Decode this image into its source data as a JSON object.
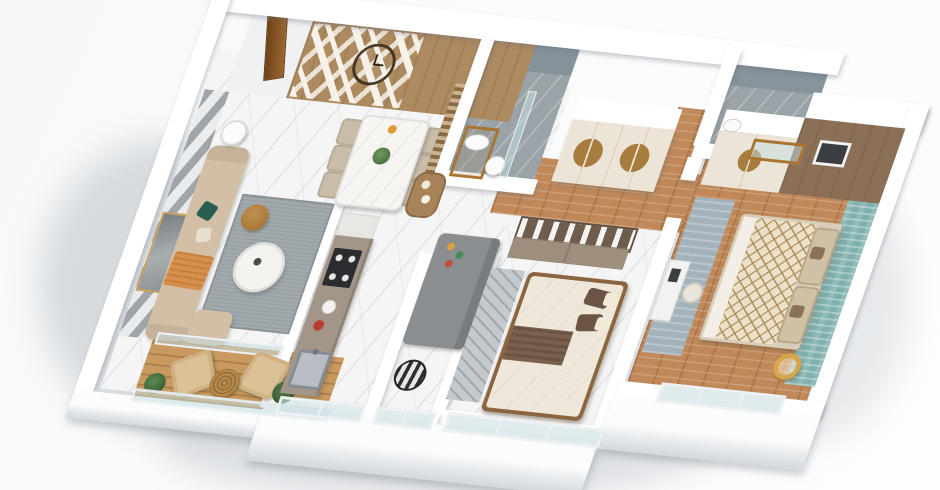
{
  "scene": {
    "type": "3d-apartment-floor-plan-render",
    "view": "isometric top-down",
    "visible_text": "none",
    "background": "#fafbfc"
  },
  "palette": {
    "outer_wall": "#ffffff",
    "wall_shadow": "#d4d9dd",
    "marble_floor": "#f5f5f6",
    "wood_floor": "#c1895a",
    "balcony_deck": "#c99a5f",
    "feature_wood_wall": "#ad8a5f",
    "accent_stripe_gray": "#9fa5a8",
    "sofa_beige": "#d3bfa6",
    "pillow_green": "#275e4d",
    "throw_orange": "#d78f4d",
    "rug_gray": "#99a1a6",
    "counter_taupe": "#a39689",
    "stove_black": "#2b2c30",
    "bathroom_gray": "#9aa3a7",
    "wardrobe_cream": "#ece4d6",
    "wood_handle": "#a87c3e",
    "closet_taupe": "#9d8e7d",
    "bed_brown_pillow": "#6b5444",
    "bed_runner_brown": "#7b604d",
    "duvet_lattice": "#ece1c8",
    "lattice_line": "#a48854",
    "teal_accent_wall": "#7fb0ae",
    "master_brown_wall": "#8b7057",
    "gold_lamp": "#d8a64a",
    "glass": "#c4dce0"
  },
  "rooms": [
    {
      "id": "living-room",
      "label": "Living Room",
      "floor": "white marble",
      "furniture": [
        "beige sofa with green and orange pillows",
        "round marble coffee table",
        "leather pouf",
        "round side table",
        "gray area rug",
        "gold framed wall art",
        "gray striped accent wall"
      ]
    },
    {
      "id": "balcony",
      "label": "Balcony",
      "floor": "wood deck",
      "furniture": [
        "two beige armchairs",
        "rattan round table",
        "potted plants",
        "glass railing"
      ]
    },
    {
      "id": "dining-area",
      "label": "Dining Area",
      "floor": "white marble",
      "furniture": [
        "marble dining table",
        "six beige chairs",
        "flower centerpiece",
        "wood slat partition",
        "bar console",
        "round wall clock",
        "wood chevron feature wall",
        "entrance door"
      ]
    },
    {
      "id": "kitchen",
      "label": "Kitchen",
      "floor": "white marble",
      "furniture": [
        "taupe galley counter",
        "black cooktop",
        "white kettle",
        "red pot",
        "steel sink",
        "tall white cabinet"
      ]
    },
    {
      "id": "study",
      "label": "Study / Kids Nook",
      "floor": "white marble",
      "furniture": [
        "gray chaise bench",
        "colorful toys",
        "zebra striped pouf"
      ]
    },
    {
      "id": "bathroom-1",
      "label": "Bathroom",
      "floor": "gray marble",
      "furniture": [
        "wood vanity with oval sink",
        "toilet",
        "glass shower screen"
      ]
    },
    {
      "id": "bathroom-2",
      "label": "Ensuite Bathroom",
      "floor": "gray marble",
      "furniture": [
        "toilet",
        "wood framed glass door"
      ]
    },
    {
      "id": "hallway",
      "label": "Hallway",
      "floor": "wood planks",
      "furniture": [
        "cream wardrobe with round wood inlay handles"
      ]
    },
    {
      "id": "bedroom-2",
      "label": "Second Bedroom",
      "floor": "light marble",
      "furniture": [
        "double bed with brown pillows",
        "brown bed runner",
        "open closet with hanging clothes",
        "patterned gray rug",
        "bottom windows"
      ]
    },
    {
      "id": "master-bedroom",
      "label": "Master Bedroom",
      "floor": "wood planks",
      "furniture": [
        "double bed with lattice duvet",
        "beige headboard cushions",
        "teal textured accent wall",
        "framed artwork on brown wall",
        "cream wardrobe",
        "white desk and chair",
        "blue-gray rug",
        "gold ring lamp",
        "bottom windows"
      ]
    }
  ]
}
